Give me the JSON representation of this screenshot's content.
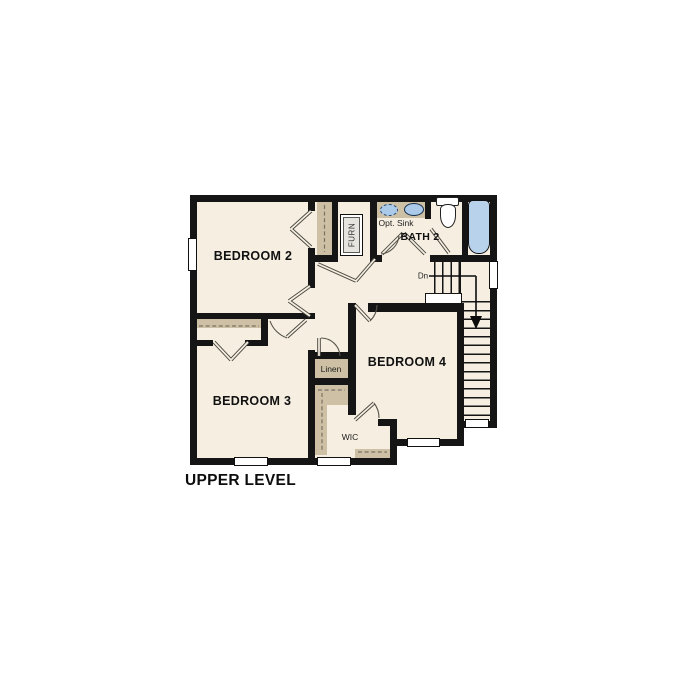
{
  "plan": {
    "title": "UPPER LEVEL",
    "labels": {
      "bedroom2": "BEDROOM 2",
      "bedroom3": "BEDROOM 3",
      "bedroom4": "BEDROOM 4",
      "bath2": "BATH 2",
      "opt_sink": "Opt. Sink",
      "furnace": "FURN",
      "stairs_down": "Dn",
      "linen": "Linen",
      "wic": "WIC"
    },
    "colors": {
      "wall": "#151515",
      "floor": "#f5eee1",
      "shelving": "#cdc0a4",
      "sink_blue": "#abc9e8",
      "tub_blue": "#b9d2ec",
      "background": "#ffffff"
    }
  }
}
